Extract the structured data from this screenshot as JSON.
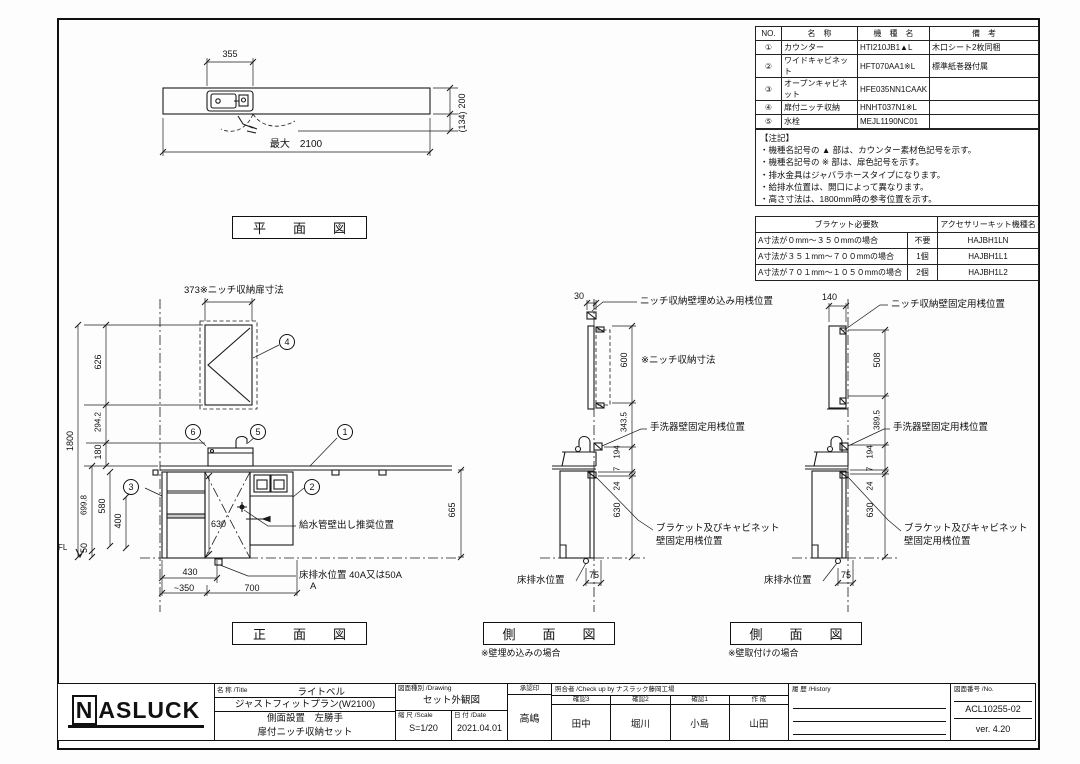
{
  "parts_table": {
    "headers": [
      "NO.",
      "名　称",
      "機　種　名",
      "備　考"
    ],
    "rows": [
      {
        "no": "①",
        "name": "カウンター",
        "model": "HTI210JB1▲L",
        "remark": "木口シート2枚同梱"
      },
      {
        "no": "②",
        "name": "ワイドキャビネット",
        "model": "HFT070AA1※L",
        "remark": "標準紙巻器付属"
      },
      {
        "no": "③",
        "name": "オープンキャビネット",
        "model": "HFE035NN1CAAK",
        "remark": ""
      },
      {
        "no": "④",
        "name": "扉付ニッチ収納",
        "model": "HNHT037N1※L",
        "remark": ""
      },
      {
        "no": "⑤",
        "name": "水栓",
        "model": "MEJL1190NC01",
        "remark": ""
      },
      {
        "no": "⑥",
        "name": "アクセサリーキット",
        "model": "下記参照",
        "remark": "キット内容：排水金具一式、手洗器ブラケット、補強桟、取付ビス"
      }
    ]
  },
  "notes": {
    "title": "【注記】",
    "items": [
      "・機種名記号の ▲ 部は、カウンター素材色記号を示す。",
      "・機種名記号の ※ 部は、扉色記号を示す。",
      "・排水金具はジャバラホースタイプになります。",
      "・給排水位置は、開口によって異なります。",
      "・高さ寸法は、1800mm時の参考位置を示す。"
    ]
  },
  "bracket_table": {
    "header_left": "ブラケット必要数",
    "header_right": "アクセサリーキット機種名",
    "rows": [
      {
        "cond": "A寸法が０mm～３５０mmの場合",
        "qty": "不要",
        "model": "HAJBH1LN"
      },
      {
        "cond": "A寸法が３５１mm～７００mmの場合",
        "qty": "1個",
        "model": "HAJBH1L1"
      },
      {
        "cond": "A寸法が７０１mm～１０５０mmの場合",
        "qty": "2個",
        "model": "HAJBH1L2"
      }
    ]
  },
  "plan": {
    "title": "平　面　図",
    "d355": "355",
    "dmax": "最大　2100",
    "d200": "200",
    "d134": "(134)"
  },
  "front": {
    "title": "正　面　図",
    "top": "373※ニッチ収納扉寸法",
    "d1800": "1800",
    "d626": "626",
    "d294": "294.2",
    "d180": "180",
    "d699": "699.8",
    "d580": "580",
    "d400": "400",
    "d50": "50",
    "d630": "630",
    "d665": "665",
    "d430": "430",
    "d350": "~350",
    "d700": "700",
    "fl": "FL",
    "supply": "給水管壁出し推奨位置",
    "drain": "床排水位置 40A又は50A",
    "drain_a": "A",
    "c1": "1",
    "c2": "2",
    "c3": "3",
    "c4": "4",
    "c5": "5",
    "c6": "6"
  },
  "side1": {
    "title": "側　面　図",
    "sub": "※壁埋め込みの場合",
    "d30": "30",
    "top": "ニッチ収納壁埋め込み用桟位置",
    "d600": "600",
    "niche": "※ニッチ収納寸法",
    "d343": "343.5",
    "d194": "194",
    "d7": "7",
    "d24": "24",
    "d630": "630",
    "d75": "75",
    "basin": "手洗器壁固定用桟位置",
    "br1": "ブラケット及びキャビネット",
    "br2": "壁固定用桟位置",
    "drain": "床排水位置"
  },
  "side2": {
    "title": "側　面　図",
    "sub": "※壁取付けの場合",
    "d140": "140",
    "top": "ニッチ収納壁固定用桟位置",
    "d508": "508",
    "d389": "389.5",
    "d194": "194",
    "d7": "7",
    "d24": "24",
    "d630": "630",
    "d75": "75",
    "basin": "手洗器壁固定用桟位置",
    "br1": "ブラケット及びキャビネット",
    "br2": "壁固定用桟位置",
    "drain": "床排水位置"
  },
  "title_block": {
    "logo_n": "N",
    "logo_rest": "ASLUCK",
    "title_header": "名 称 /Title",
    "title_line1": "ライトベル",
    "title_line2": "ジャストフィットプラン(W2100)",
    "title_line3": "側面設置　左勝手",
    "title_line4": "扉付ニッチ収納セット",
    "drawing_header": "図面種別 /Drawing",
    "drawing_type": "セット外観図",
    "scale_header": "縮 尺 /Scale",
    "scale": "S=1/20",
    "date_header": "日 付 /Date",
    "date": "2021.04.01",
    "approval_header": "承認印",
    "approval": "高嶋",
    "check_header": "照合者 /Check up by ナスラック藤岡工場",
    "check_cols": [
      {
        "role": "確認3",
        "name": "田中"
      },
      {
        "role": "確認2",
        "name": "堀川"
      },
      {
        "role": "確認1",
        "name": "小島"
      },
      {
        "role": "作 成",
        "name": "山田"
      }
    ],
    "history_header": "履 歴 /History",
    "no_header": "図面番号 /No.",
    "drawing_no": "ACL10255-02",
    "version": "ver. 4.20"
  }
}
